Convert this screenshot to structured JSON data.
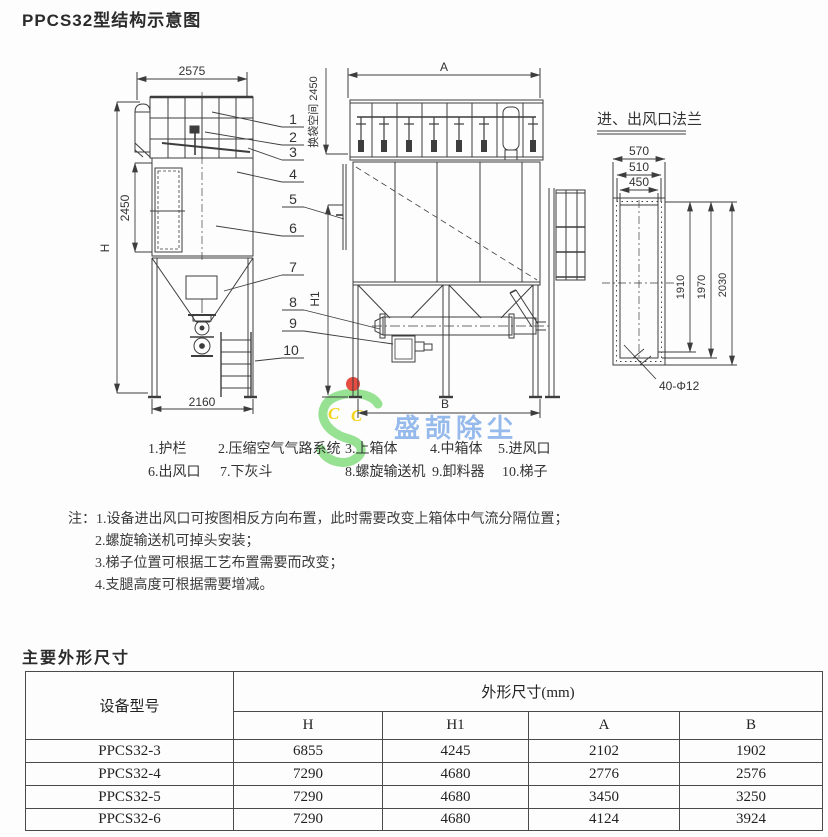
{
  "page": {
    "title": "PPCS32型结构示意图",
    "section2_title": "主要外形尺寸"
  },
  "drawing": {
    "line_color": "#3d3d3d",
    "left_view": {
      "dim_width_top": "2575",
      "dim_h": "H",
      "dim_2450": "2450",
      "dim_bag_space": "换袋空间 2450",
      "dim_width_bottom": "2160"
    },
    "front_view": {
      "dim_a": "A",
      "dim_h1": "H1",
      "dim_b": "B"
    },
    "flange_view": {
      "title": "进、出风口法兰",
      "dim_570": "570",
      "dim_510": "510",
      "dim_450": "450",
      "dim_1910": "1910",
      "dim_1970": "1970",
      "dim_2030": "2030",
      "bolt_note": "40-Φ12"
    },
    "callouts": [
      "1",
      "2",
      "3",
      "4",
      "5",
      "6",
      "7",
      "8",
      "9",
      "10"
    ]
  },
  "watermark": {
    "text": "盛颉除尘",
    "letters_c1": "C",
    "letters_c2": "C",
    "colors": {
      "green": "#85dc80",
      "yellow": "#f2d41c",
      "red": "#e63a2e",
      "blue": "#74a4e6"
    }
  },
  "legend": {
    "row1": [
      "1.护栏",
      "2.压缩空气气路系统",
      "3.上箱体",
      "4.中箱体",
      "5.进风口"
    ],
    "row2": [
      "6.出风口",
      "7.下灰斗",
      "8.螺旋输送机",
      "9.卸料器",
      "10.梯子"
    ]
  },
  "notes": {
    "prefix": "注：",
    "items": [
      "1.设备进出风口可按图相反方向布置，此时需要改变上箱体中气流分隔位置；",
      "2.螺旋输送机可掉头安装；",
      "3.梯子位置可根据工艺布置需要而改变；",
      "4.支腿高度可根据需要增减。"
    ]
  },
  "table": {
    "col_model": "设备型号",
    "col_group": "外形尺寸(mm)",
    "sub_columns": [
      "H",
      "H1",
      "A",
      "B"
    ],
    "rows": [
      [
        "PPCS32-3",
        "6855",
        "4245",
        "2102",
        "1902"
      ],
      [
        "PPCS32-4",
        "7290",
        "4680",
        "2776",
        "2576"
      ],
      [
        "PPCS32-5",
        "7290",
        "4680",
        "3450",
        "3250"
      ],
      [
        "PPCS32-6",
        "7290",
        "4680",
        "4124",
        "3924"
      ]
    ]
  }
}
